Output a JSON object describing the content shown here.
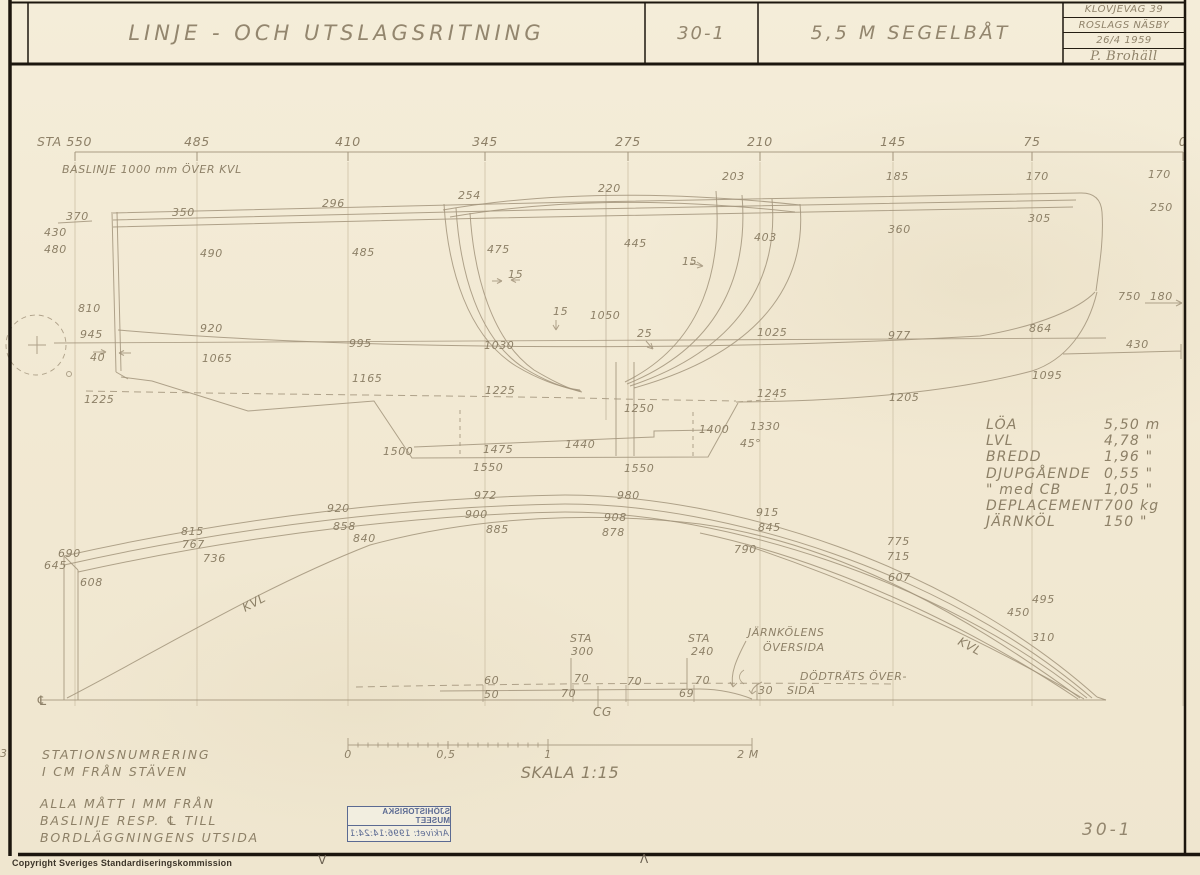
{
  "title_block": {
    "title": "LINJE - OCH UTSLAGSRITNING",
    "drawing_number": "30-1",
    "subtitle": "5,5 M SEGELBÅT",
    "info_rows": [
      "KLÖVJEVÄG 39",
      "ROSLAGS NÄSBY",
      "26/4 1959",
      "P. Brohäll"
    ]
  },
  "station_scale": {
    "baseline_note": "BASLINJE 1000 mm ÖVER KVL",
    "stations": [
      {
        "label": "STA 550",
        "x": 75,
        "lx": 37
      },
      {
        "label": "485",
        "x": 197
      },
      {
        "label": "410",
        "x": 348
      },
      {
        "label": "345",
        "x": 485
      },
      {
        "label": "275",
        "x": 628
      },
      {
        "label": "210",
        "x": 760
      },
      {
        "label": "145",
        "x": 893
      },
      {
        "label": "75",
        "x": 1032
      },
      {
        "label": "0",
        "x": 1183
      }
    ]
  },
  "specs": {
    "rows": [
      {
        "label": "LÖA",
        "value": "5,50 m"
      },
      {
        "label": "LVL",
        "value": "4,78 \""
      },
      {
        "label": "BREDD",
        "value": "1,96 \""
      },
      {
        "label": "DJUPGÅENDE",
        "value": "0,55 \""
      },
      {
        "label": "\" med CB",
        "value": "1,05 \""
      },
      {
        "label": "DEPLACEMENT",
        "value": "700 kg"
      },
      {
        "label": "JÄRNKÖL",
        "value": "150 \""
      }
    ]
  },
  "notes": {
    "station_note": [
      "STATIONSNUMRERING",
      "I CM FRÅN STÄVEN"
    ],
    "measure_note": [
      "ALLA MÅTT I MM FRÅN",
      "BASLINJE RESP. ℄ TILL",
      "BORDLÄGGNINGENS UTSIDA"
    ]
  },
  "scale_bar": {
    "label": "SKALA 1:15",
    "tick_labels": [
      {
        "text": "0",
        "x": 348
      },
      {
        "text": "0,5",
        "x": 446
      },
      {
        "text": "1",
        "x": 548
      },
      {
        "text": "2 M",
        "x": 748
      }
    ]
  },
  "stamp": {
    "line1": "SJÖHISTORISKA MUSEET",
    "line2": "Arkivet: 1996:14:24:1"
  },
  "footer": {
    "copyright": "Copyright Sveriges Standardiseringskommission",
    "sheet_number": "30-1",
    "reg_mark_left": "V",
    "reg_mark_right": "Λ",
    "margin_mark": "3"
  },
  "drawing_labels": [
    {
      "t": "203",
      "x": 722,
      "y": 180
    },
    {
      "t": "185",
      "x": 886,
      "y": 180
    },
    {
      "t": "170",
      "x": 1026,
      "y": 180
    },
    {
      "t": "170",
      "x": 1148,
      "y": 178
    },
    {
      "t": "250",
      "x": 1150,
      "y": 211
    },
    {
      "t": "360",
      "x": 888,
      "y": 233
    },
    {
      "t": "305",
      "x": 1028,
      "y": 222
    },
    {
      "t": "296",
      "x": 322,
      "y": 207
    },
    {
      "t": "350",
      "x": 172,
      "y": 216
    },
    {
      "t": "370",
      "x": 66,
      "y": 220
    },
    {
      "t": "430",
      "x": 44,
      "y": 236
    },
    {
      "t": "480",
      "x": 44,
      "y": 253
    },
    {
      "t": "490",
      "x": 200,
      "y": 257
    },
    {
      "t": "485",
      "x": 352,
      "y": 256
    },
    {
      "t": "254",
      "x": 458,
      "y": 199
    },
    {
      "t": "220",
      "x": 598,
      "y": 192
    },
    {
      "t": "475",
      "x": 487,
      "y": 253
    },
    {
      "t": "445",
      "x": 624,
      "y": 247
    },
    {
      "t": "403",
      "x": 754,
      "y": 241
    },
    {
      "t": "15",
      "x": 508,
      "y": 278
    },
    {
      "t": "15",
      "x": 682,
      "y": 265
    },
    {
      "t": "15",
      "x": 553,
      "y": 315
    },
    {
      "t": "1050",
      "x": 590,
      "y": 319
    },
    {
      "t": "25",
      "x": 637,
      "y": 337
    },
    {
      "t": "810",
      "x": 78,
      "y": 312
    },
    {
      "t": "945",
      "x": 80,
      "y": 338
    },
    {
      "t": "40",
      "x": 90,
      "y": 361
    },
    {
      "t": "920",
      "x": 200,
      "y": 332
    },
    {
      "t": "995",
      "x": 349,
      "y": 347
    },
    {
      "t": "1030",
      "x": 484,
      "y": 349
    },
    {
      "t": "1025",
      "x": 757,
      "y": 336
    },
    {
      "t": "977",
      "x": 888,
      "y": 339
    },
    {
      "t": "864",
      "x": 1029,
      "y": 332
    },
    {
      "t": "750",
      "x": 1118,
      "y": 300
    },
    {
      "t": "180",
      "x": 1150,
      "y": 300
    },
    {
      "t": "430",
      "x": 1126,
      "y": 348
    },
    {
      "t": "1065",
      "x": 202,
      "y": 362
    },
    {
      "t": "1165",
      "x": 352,
      "y": 382
    },
    {
      "t": "1095",
      "x": 1032,
      "y": 379
    },
    {
      "t": "1205",
      "x": 889,
      "y": 401
    },
    {
      "t": "1225",
      "x": 84,
      "y": 403
    },
    {
      "t": "1225",
      "x": 485,
      "y": 394
    },
    {
      "t": "1245",
      "x": 757,
      "y": 397
    },
    {
      "t": "1250",
      "x": 624,
      "y": 412
    },
    {
      "t": "1400",
      "x": 699,
      "y": 433
    },
    {
      "t": "1330",
      "x": 750,
      "y": 430
    },
    {
      "t": "45°",
      "x": 740,
      "y": 447
    },
    {
      "t": "1440",
      "x": 565,
      "y": 448
    },
    {
      "t": "1475",
      "x": 483,
      "y": 453
    },
    {
      "t": "1500",
      "x": 383,
      "y": 455
    },
    {
      "t": "1550",
      "x": 473,
      "y": 471
    },
    {
      "t": "1550",
      "x": 624,
      "y": 472
    },
    {
      "t": "972",
      "x": 474,
      "y": 499
    },
    {
      "t": "980",
      "x": 617,
      "y": 499
    },
    {
      "t": "920",
      "x": 327,
      "y": 512
    },
    {
      "t": "900",
      "x": 465,
      "y": 518
    },
    {
      "t": "908",
      "x": 604,
      "y": 521
    },
    {
      "t": "915",
      "x": 756,
      "y": 516
    },
    {
      "t": "858",
      "x": 333,
      "y": 530
    },
    {
      "t": "885",
      "x": 486,
      "y": 533
    },
    {
      "t": "878",
      "x": 602,
      "y": 536
    },
    {
      "t": "845",
      "x": 758,
      "y": 531
    },
    {
      "t": "815",
      "x": 181,
      "y": 535
    },
    {
      "t": "767",
      "x": 182,
      "y": 548
    },
    {
      "t": "840",
      "x": 353,
      "y": 542
    },
    {
      "t": "736",
      "x": 203,
      "y": 562
    },
    {
      "t": "690",
      "x": 58,
      "y": 557
    },
    {
      "t": "645",
      "x": 44,
      "y": 569
    },
    {
      "t": "608",
      "x": 80,
      "y": 586
    },
    {
      "t": "790",
      "x": 734,
      "y": 553
    },
    {
      "t": "775",
      "x": 887,
      "y": 545
    },
    {
      "t": "715",
      "x": 887,
      "y": 560
    },
    {
      "t": "607",
      "x": 888,
      "y": 581
    },
    {
      "t": "495",
      "x": 1032,
      "y": 603
    },
    {
      "t": "450",
      "x": 1007,
      "y": 616
    },
    {
      "t": "310",
      "x": 1032,
      "y": 641
    },
    {
      "t": "KVL",
      "x": 245,
      "y": 612,
      "r": -28,
      "s": 12
    },
    {
      "t": "KVL",
      "x": 957,
      "y": 644,
      "r": 28,
      "s": 12
    },
    {
      "t": "STA",
      "x": 570,
      "y": 642
    },
    {
      "t": "300",
      "x": 571,
      "y": 655
    },
    {
      "t": "STA",
      "x": 688,
      "y": 642
    },
    {
      "t": "240",
      "x": 691,
      "y": 655
    },
    {
      "t": "JÄRNKÖLENS",
      "x": 748,
      "y": 636
    },
    {
      "t": "ÖVERSIDA",
      "x": 763,
      "y": 651
    },
    {
      "t": "DÖDTRÄTS ÖVER-",
      "x": 800,
      "y": 680
    },
    {
      "t": "SIDA",
      "x": 787,
      "y": 694
    },
    {
      "t": "60",
      "x": 484,
      "y": 684
    },
    {
      "t": "70",
      "x": 574,
      "y": 682
    },
    {
      "t": "70",
      "x": 627,
      "y": 685
    },
    {
      "t": "70",
      "x": 695,
      "y": 684
    },
    {
      "t": "50",
      "x": 484,
      "y": 698
    },
    {
      "t": "70",
      "x": 561,
      "y": 697
    },
    {
      "t": "69",
      "x": 679,
      "y": 697
    },
    {
      "t": "30",
      "x": 758,
      "y": 694
    },
    {
      "t": "CG",
      "x": 593,
      "y": 716,
      "s": 12
    },
    {
      "t": "℄",
      "x": 36,
      "y": 705,
      "s": 13
    }
  ]
}
